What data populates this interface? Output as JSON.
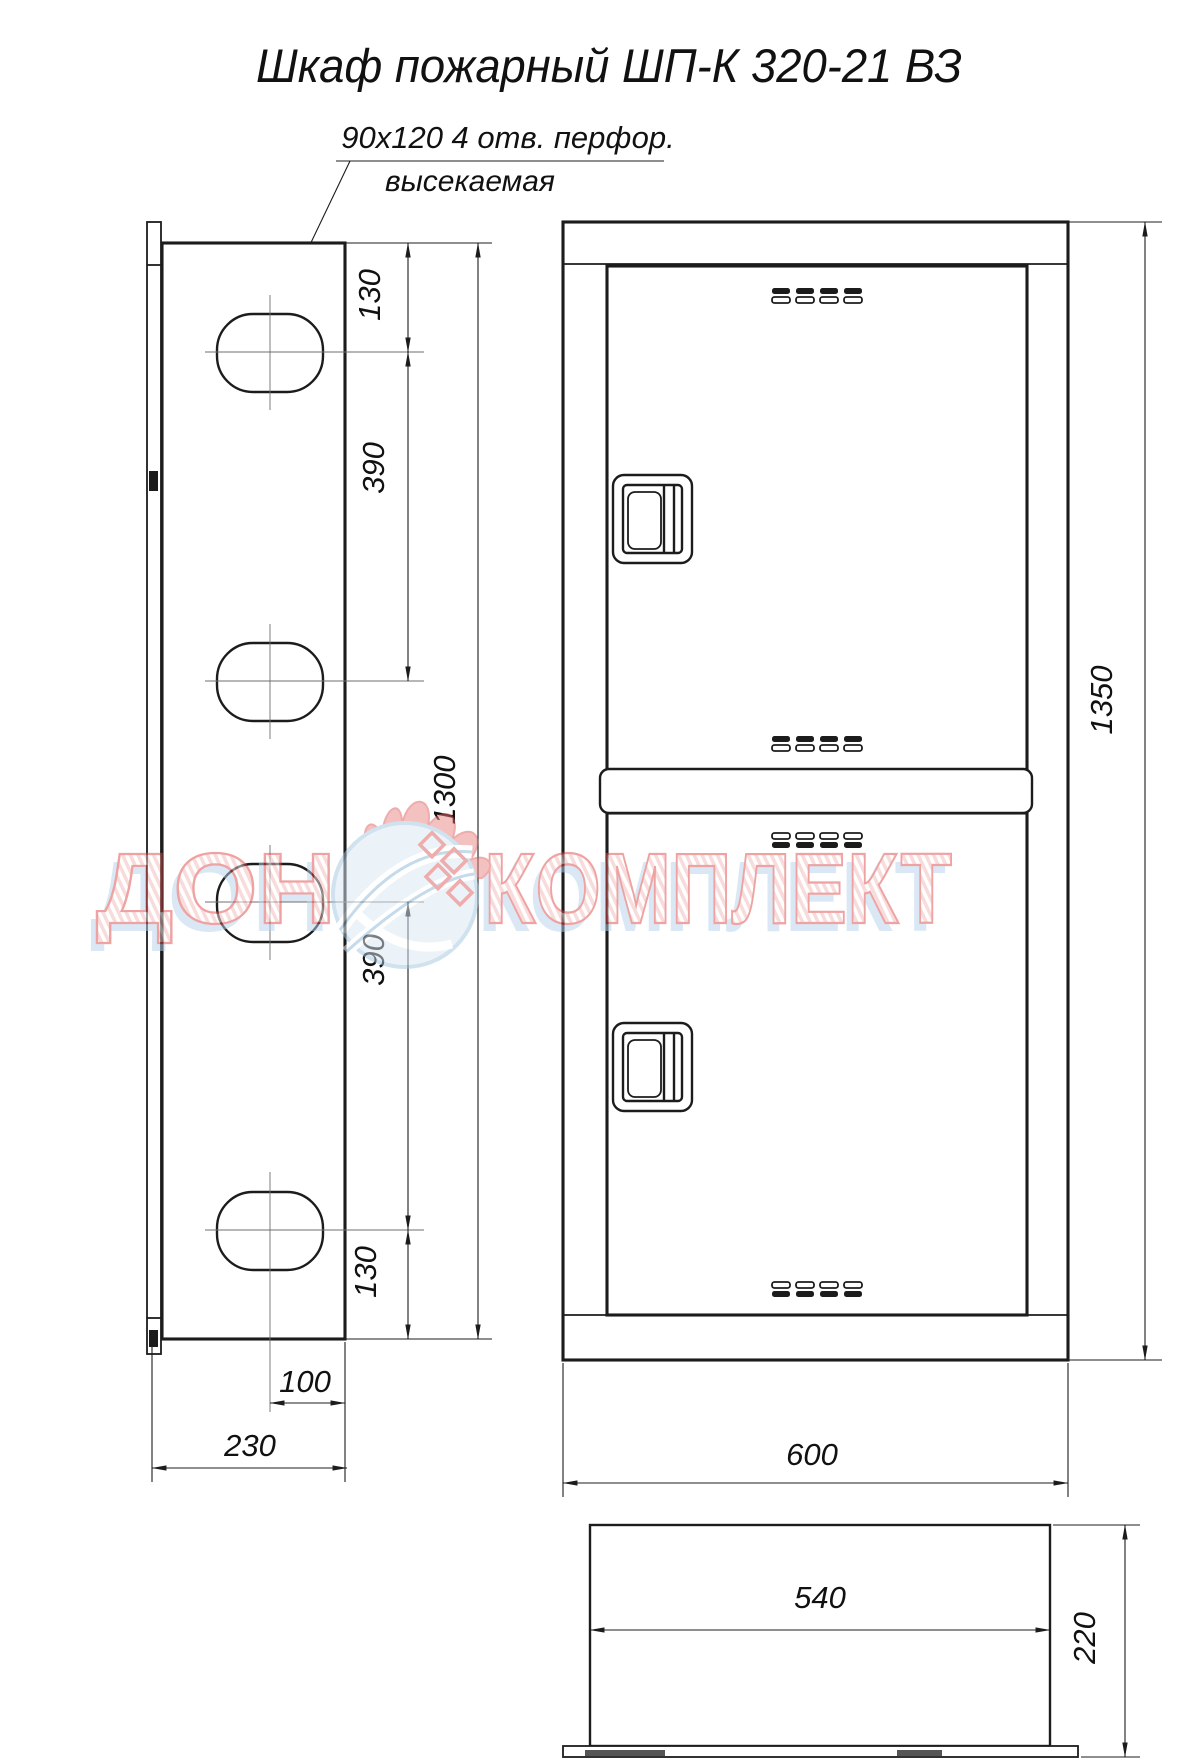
{
  "title": "Шкаф пожарный ШП-К 320-21 ВЗ",
  "annotation": {
    "perforation": "90x120  4 отв. перфор.",
    "cut": "высекаемая"
  },
  "dims": {
    "side_top_offset": "130",
    "side_hole_spacing_top": "390",
    "side_overall_height": "1300",
    "side_hole_spacing_bottom": "390",
    "side_bottom_offset": "130",
    "side_hole_to_edge": "100",
    "side_depth": "230",
    "front_height": "1350",
    "front_width": "600",
    "top_inner_width": "540",
    "top_depth": "220"
  },
  "watermark": {
    "word1": "ДОН",
    "word2": "КОМПЛЕКТ"
  },
  "colors": {
    "line": "#1c1c1c",
    "watermark_red": "#e04848",
    "watermark_blue": "#b5d3ea"
  }
}
